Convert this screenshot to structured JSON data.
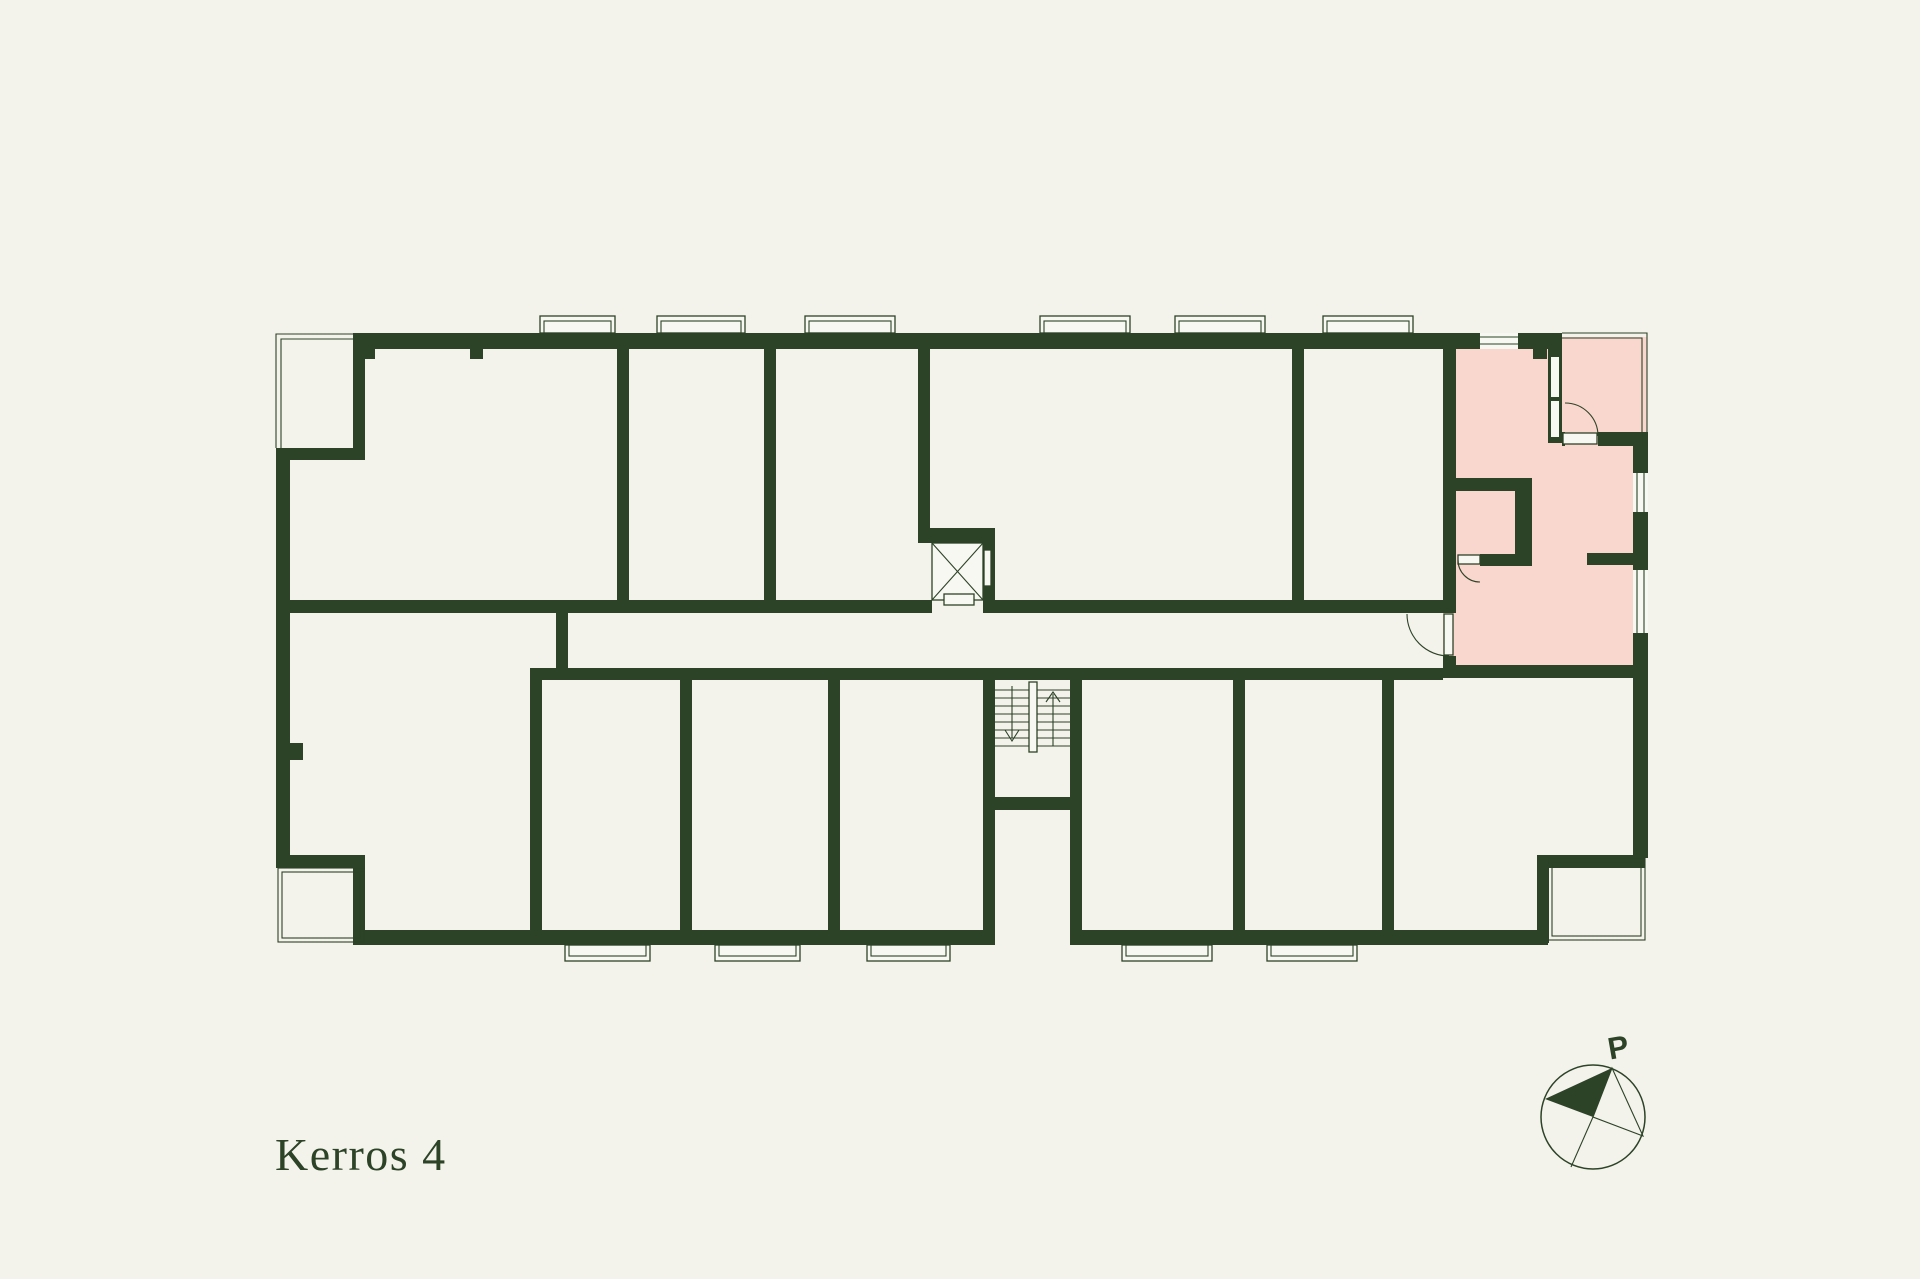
{
  "page": {
    "background": "#f3f3ec"
  },
  "colors": {
    "bg": "#f3f3ec",
    "wall": "#2d4327",
    "line": "#2d4327",
    "floor": "#f8f8f2",
    "highlight": "#f9d6ce"
  },
  "floor_label": "Kerros 4",
  "compass": {
    "label": "P"
  }
}
